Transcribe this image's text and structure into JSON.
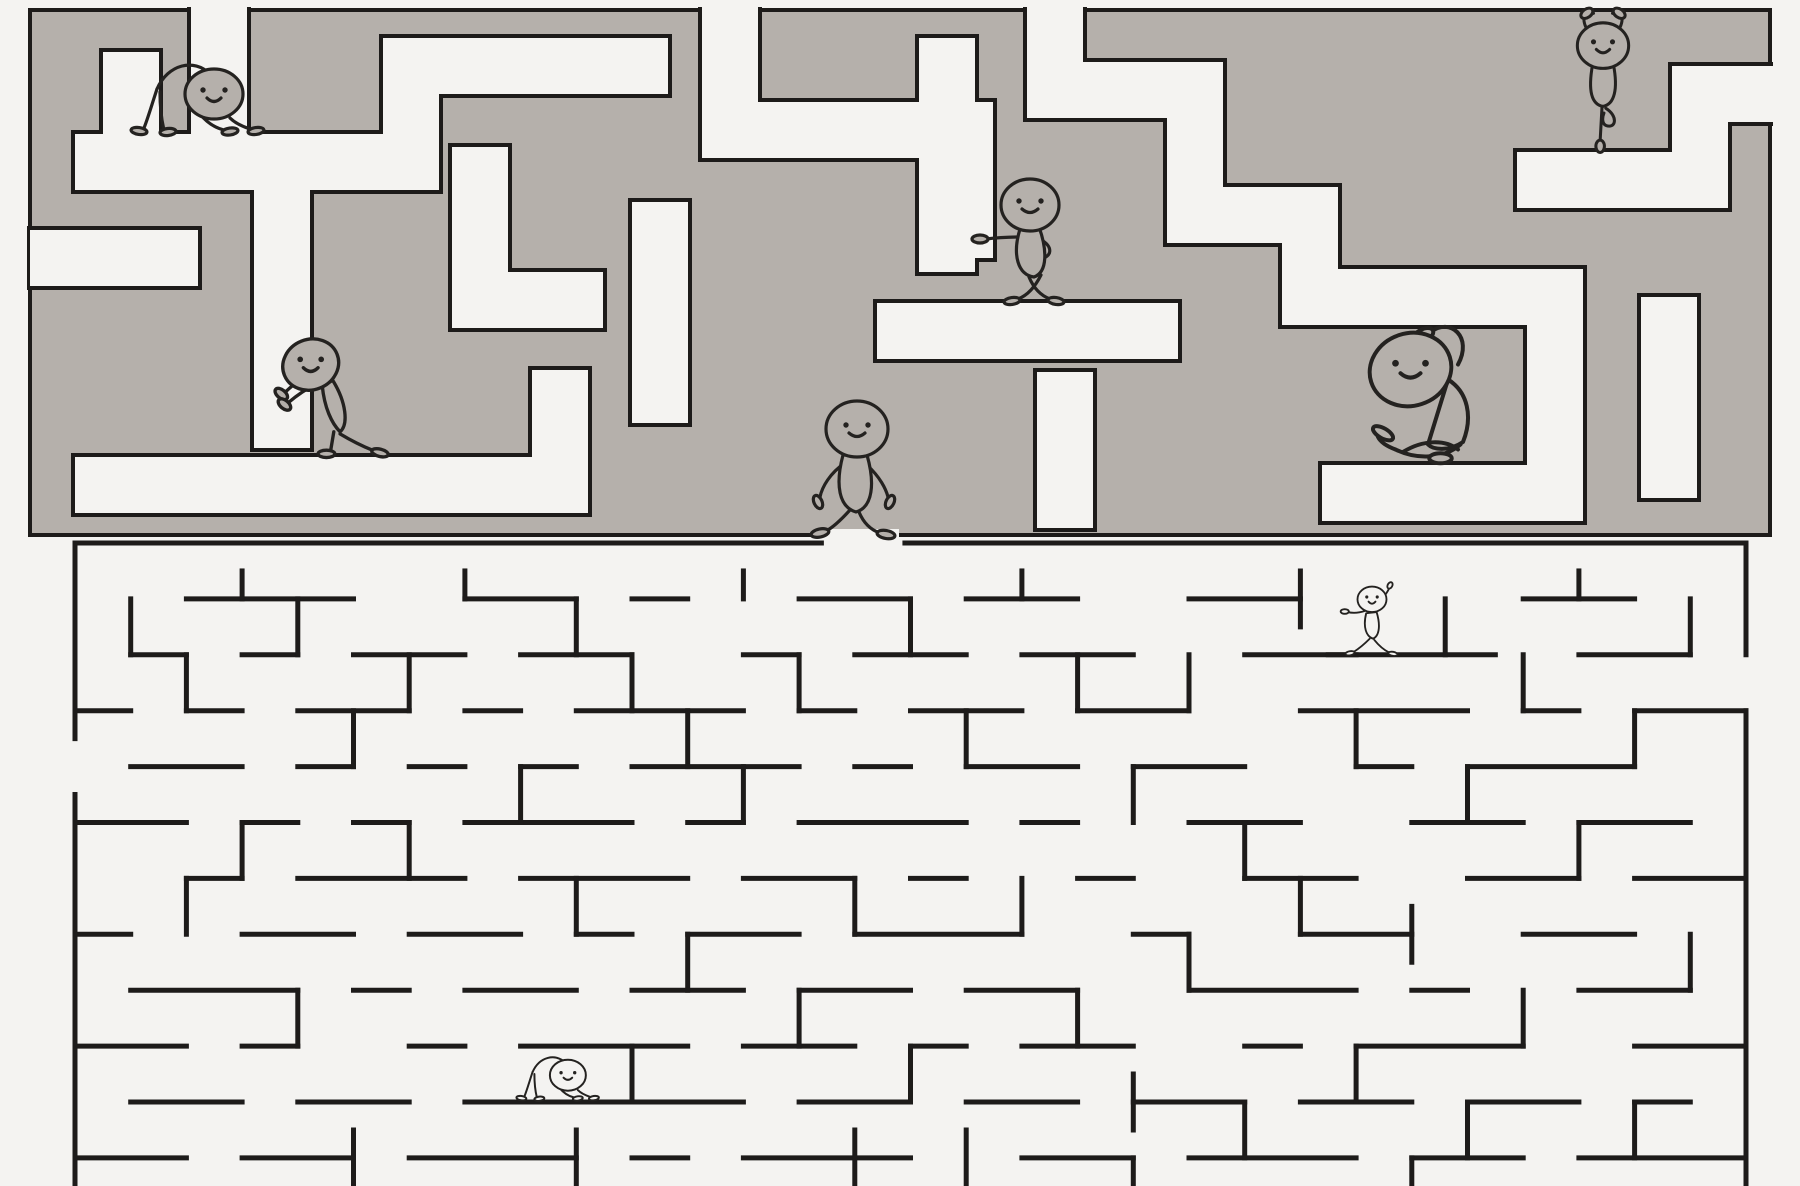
{
  "scene": {
    "width": 1800,
    "height": 1186,
    "background_color": "#f4f3f1",
    "description_name": "yoga-characters-double-maze"
  },
  "colors": {
    "upper_maze_fill": "#b5b0ab",
    "outline": "#1d1b1a",
    "corridor": "#f4f3f1",
    "lower_wall": "#1d1b1a",
    "character_stroke": "#242220"
  },
  "upper_maze": {
    "slab": {
      "x": 30,
      "y": 10,
      "w": 1740,
      "h": 525
    },
    "outline_width": 4,
    "corridor_width": 56,
    "corridors": [
      {
        "pts": [
          [
            219,
            -14
          ],
          [
            219,
            162
          ]
        ]
      },
      {
        "pts": [
          [
            131,
            80
          ],
          [
            131,
            162
          ]
        ]
      },
      {
        "pts": [
          [
            103,
            162
          ],
          [
            411,
            162
          ]
        ]
      },
      {
        "pts": [
          [
            411,
            162
          ],
          [
            411,
            66
          ],
          [
            640,
            66
          ]
        ]
      },
      {
        "pts": [
          [
            730,
            -14
          ],
          [
            730,
            130
          ],
          [
            965,
            130
          ],
          [
            965,
            230
          ]
        ]
      },
      {
        "pts": [
          [
            1055,
            -14
          ],
          [
            1055,
            90
          ],
          [
            1195,
            90
          ],
          [
            1195,
            215
          ],
          [
            1310,
            215
          ],
          [
            1310,
            297
          ],
          [
            1555,
            297
          ]
        ]
      },
      {
        "pts": [
          [
            1545,
            180
          ],
          [
            1700,
            180
          ],
          [
            1700,
            94
          ],
          [
            1786,
            94
          ]
        ]
      },
      {
        "pts": [
          [
            947,
            66
          ],
          [
            947,
            244
          ]
        ]
      },
      {
        "pts": [
          [
            905,
            331
          ],
          [
            1150,
            331
          ]
        ]
      },
      {
        "pts": [
          [
            282,
            205
          ],
          [
            282,
            420
          ]
        ]
      },
      {
        "pts": [
          [
            103,
            485
          ],
          [
            560,
            485
          ],
          [
            560,
            398
          ]
        ]
      },
      {
        "pts": [
          [
            480,
            175
          ],
          [
            480,
            300
          ],
          [
            575,
            300
          ]
        ]
      },
      {
        "pts": [
          [
            660,
            230
          ],
          [
            660,
            395
          ]
        ]
      },
      {
        "pts": [
          [
            1555,
            297
          ],
          [
            1555,
            493
          ],
          [
            1350,
            493
          ]
        ]
      },
      {
        "pts": [
          [
            1669,
            325
          ],
          [
            1669,
            470
          ]
        ]
      },
      {
        "pts": [
          [
            58,
            258
          ],
          [
            170,
            258
          ]
        ]
      },
      {
        "pts": [
          [
            1065,
            400
          ],
          [
            1065,
            500
          ]
        ]
      }
    ],
    "bottom_exit_gap": {
      "x": 823,
      "y": 529,
      "w": 76,
      "h": 18
    }
  },
  "lower_maze": {
    "origin": [
      75,
      543
    ],
    "cell": [
      55.7,
      55.9
    ],
    "line_width": 5,
    "h_walls": [
      [
        0,
        0,
        13.4
      ],
      [
        14.9,
        0,
        30
      ],
      [
        2,
        1,
        5
      ],
      [
        7,
        1,
        9
      ],
      [
        10,
        1,
        11
      ],
      [
        13,
        1,
        15
      ],
      [
        16,
        1,
        18
      ],
      [
        20,
        1,
        22
      ],
      [
        26,
        1,
        28
      ],
      [
        1,
        2,
        2
      ],
      [
        3,
        2,
        4
      ],
      [
        5,
        2,
        7
      ],
      [
        8,
        2,
        10
      ],
      [
        12,
        2,
        13
      ],
      [
        14,
        2,
        16
      ],
      [
        17,
        2,
        19
      ],
      [
        21,
        2,
        23
      ],
      [
        22.5,
        2,
        25.5
      ],
      [
        27,
        2,
        29
      ],
      [
        0,
        3,
        1
      ],
      [
        2,
        3,
        3
      ],
      [
        4,
        3,
        6
      ],
      [
        7,
        3,
        8
      ],
      [
        9,
        3,
        12
      ],
      [
        13,
        3,
        14
      ],
      [
        15,
        3,
        17
      ],
      [
        18,
        3,
        20
      ],
      [
        22,
        3,
        25
      ],
      [
        26,
        3,
        27
      ],
      [
        28,
        3,
        30
      ],
      [
        1,
        4,
        3
      ],
      [
        4,
        4,
        5
      ],
      [
        6,
        4,
        7
      ],
      [
        8,
        4,
        9
      ],
      [
        10,
        4,
        13
      ],
      [
        14,
        4,
        15
      ],
      [
        16,
        4,
        18
      ],
      [
        19,
        4,
        21
      ],
      [
        23,
        4,
        24
      ],
      [
        25,
        4,
        28
      ],
      [
        0,
        5,
        2
      ],
      [
        3,
        5,
        4
      ],
      [
        5,
        5,
        6
      ],
      [
        7,
        5,
        10
      ],
      [
        11,
        5,
        12
      ],
      [
        13,
        5,
        16
      ],
      [
        17,
        5,
        18
      ],
      [
        20,
        5,
        22
      ],
      [
        24,
        5,
        26
      ],
      [
        27,
        5,
        29
      ],
      [
        2,
        6,
        3
      ],
      [
        4,
        6,
        7
      ],
      [
        8,
        6,
        11
      ],
      [
        12,
        6,
        14
      ],
      [
        15,
        6,
        16
      ],
      [
        18,
        6,
        19
      ],
      [
        21,
        6,
        23
      ],
      [
        25,
        6,
        27
      ],
      [
        28,
        6,
        30
      ],
      [
        0,
        7,
        1
      ],
      [
        3,
        7,
        5
      ],
      [
        6,
        7,
        8
      ],
      [
        9,
        7,
        10
      ],
      [
        11,
        7,
        13
      ],
      [
        14,
        7,
        17
      ],
      [
        19,
        7,
        20
      ],
      [
        22,
        7,
        24
      ],
      [
        26,
        7,
        28
      ],
      [
        1,
        8,
        4
      ],
      [
        5,
        8,
        6
      ],
      [
        7,
        8,
        9
      ],
      [
        10,
        8,
        12
      ],
      [
        13,
        8,
        15
      ],
      [
        16,
        8,
        18
      ],
      [
        20,
        8,
        23
      ],
      [
        24,
        8,
        25
      ],
      [
        27,
        8,
        29
      ],
      [
        0,
        9,
        2
      ],
      [
        3,
        9,
        4
      ],
      [
        6,
        9,
        7
      ],
      [
        8,
        9,
        11
      ],
      [
        12,
        9,
        14
      ],
      [
        15,
        9,
        16
      ],
      [
        17,
        9,
        19
      ],
      [
        21,
        9,
        22
      ],
      [
        23,
        9,
        26
      ],
      [
        28,
        9,
        30
      ],
      [
        1,
        10,
        3
      ],
      [
        4,
        10,
        6
      ],
      [
        7,
        10,
        12
      ],
      [
        13,
        10,
        15
      ],
      [
        16,
        10,
        18
      ],
      [
        19,
        10,
        21
      ],
      [
        22,
        10,
        24
      ],
      [
        25,
        10,
        27
      ],
      [
        28,
        10,
        29
      ],
      [
        0,
        11,
        2
      ],
      [
        3,
        11,
        5
      ],
      [
        6,
        11,
        9
      ],
      [
        10,
        11,
        11
      ],
      [
        12,
        11,
        15
      ],
      [
        17,
        11,
        19
      ],
      [
        20,
        11,
        23
      ],
      [
        24,
        11,
        26
      ],
      [
        27,
        11,
        30
      ]
    ],
    "v_walls": [
      [
        0,
        0,
        3.5
      ],
      [
        0,
        4.5,
        11.7
      ],
      [
        30,
        0,
        2
      ],
      [
        30,
        3,
        11.7
      ],
      [
        1,
        1,
        2
      ],
      [
        2,
        2,
        3
      ],
      [
        3,
        0.5,
        1
      ],
      [
        4,
        1,
        2
      ],
      [
        5,
        3,
        4
      ],
      [
        6,
        2,
        3
      ],
      [
        6,
        5,
        6
      ],
      [
        7,
        0.5,
        1
      ],
      [
        8,
        4,
        5
      ],
      [
        9,
        1,
        2
      ],
      [
        9,
        6,
        7
      ],
      [
        10,
        2,
        3
      ],
      [
        11,
        3,
        4
      ],
      [
        11,
        7,
        8
      ],
      [
        12,
        0.5,
        1
      ],
      [
        12,
        4,
        5
      ],
      [
        13,
        2,
        3
      ],
      [
        13,
        8,
        9
      ],
      [
        14,
        6,
        7
      ],
      [
        15,
        1,
        2
      ],
      [
        15,
        9,
        10
      ],
      [
        16,
        3,
        4
      ],
      [
        17,
        0.5,
        1
      ],
      [
        17,
        6,
        7
      ],
      [
        18,
        2,
        3
      ],
      [
        18,
        8,
        9
      ],
      [
        19,
        4,
        5
      ],
      [
        19,
        9.5,
        10.5
      ],
      [
        20,
        2,
        3
      ],
      [
        20,
        7,
        8
      ],
      [
        21,
        5,
        6
      ],
      [
        21,
        10,
        11
      ],
      [
        22,
        0.5,
        1.5
      ],
      [
        22,
        6,
        7
      ],
      [
        23,
        3,
        4
      ],
      [
        23,
        9,
        10
      ],
      [
        24.6,
        1,
        2
      ],
      [
        24,
        6.5,
        7.5
      ],
      [
        25,
        4,
        5
      ],
      [
        25,
        10,
        11
      ],
      [
        26,
        2,
        3
      ],
      [
        26,
        8,
        9
      ],
      [
        27,
        0.5,
        1
      ],
      [
        27,
        5,
        6
      ],
      [
        28,
        3,
        4
      ],
      [
        28,
        10,
        11
      ],
      [
        29,
        1,
        2
      ],
      [
        29,
        7,
        8
      ],
      [
        2,
        6,
        7
      ],
      [
        3,
        5,
        6
      ],
      [
        4,
        8,
        9
      ],
      [
        10,
        9,
        10
      ],
      [
        5,
        10.5,
        11.7
      ],
      [
        9,
        10.5,
        11.7
      ],
      [
        14,
        10.5,
        11.7
      ],
      [
        19,
        11,
        11.7
      ],
      [
        24,
        11,
        11.7
      ],
      [
        16,
        10.5,
        11.5
      ]
    ]
  },
  "characters": [
    {
      "id": "downward-dog-upper",
      "pose": "downdog",
      "x": 190,
      "y": 134,
      "scale": 1.0,
      "fill": "#b5b0ab"
    },
    {
      "id": "tree-pose",
      "pose": "tree",
      "x": 1603,
      "y": 152,
      "scale": 0.95,
      "fill": "#b5b0ab"
    },
    {
      "id": "leaning-on-wall",
      "pose": "lean",
      "x": 1032,
      "y": 303,
      "scale": 1.0,
      "fill": "#b5b0ab"
    },
    {
      "id": "wall-push-stretch",
      "pose": "push",
      "x": 338,
      "y": 457,
      "scale": 1.05,
      "fill": "#b5b0ab"
    },
    {
      "id": "walking-to-exit",
      "pose": "walk",
      "x": 858,
      "y": 537,
      "scale": 1.0,
      "fill": "#b5b0ab"
    },
    {
      "id": "seated-side-stretch",
      "pose": "sidestretch",
      "x": 1438,
      "y": 462,
      "scale": 1.25,
      "fill": "#b5b0ab"
    },
    {
      "id": "lunge-lower",
      "pose": "lunge",
      "x": 1372,
      "y": 655,
      "scale": 0.58,
      "fill": "#f4f3f1"
    },
    {
      "id": "downward-dog-lower",
      "pose": "downdog",
      "x": 553,
      "y": 1100,
      "scale": 0.62,
      "fill": "#f4f3f1"
    }
  ]
}
